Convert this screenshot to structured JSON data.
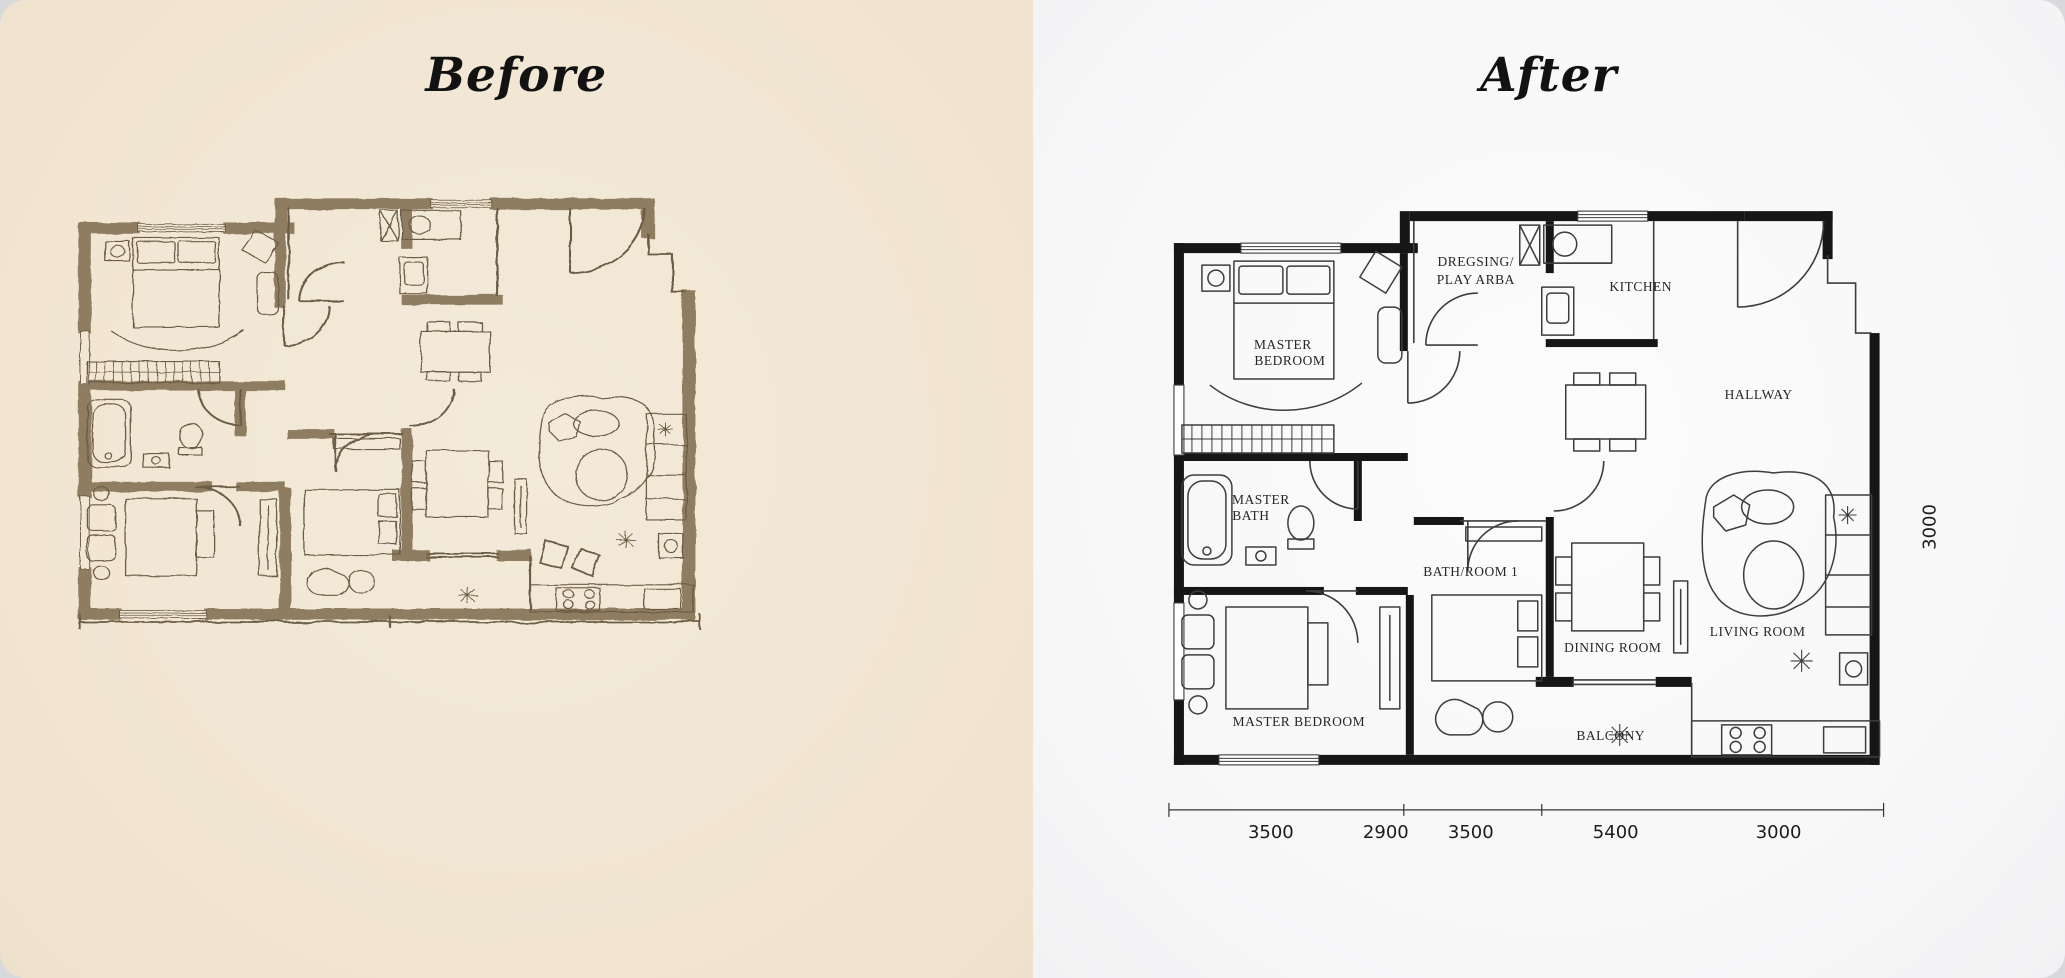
{
  "page": {
    "background_color": "#d8d9db",
    "card_radius_px": 26
  },
  "before_panel": {
    "title": "Before",
    "background_color": "#f2e7d5",
    "description": "hand-drawn sepia sketch floor plan",
    "ink_color": "#6b5b44",
    "wall_color": "#8e7d61"
  },
  "after_panel": {
    "title": "After",
    "background_color": "#f7f7f8",
    "description": "clean CAD floor plan",
    "wall_color": "#161616",
    "rooms": {
      "master_bedroom_top": [
        "MASTER",
        "BEDROOM"
      ],
      "dressing": [
        "DREGSING/",
        "PLAY ARBA"
      ],
      "kitchen": "KITCHEN",
      "hallway": "HALLWAY",
      "master_bath": [
        "MASTER",
        "BATH"
      ],
      "bathroom_1": "BATH/ROOM 1",
      "dining_room": "DINING ROOM",
      "living_room": "LIVING ROOM",
      "master_bedroom_bottom": "MASTER BEDROOM",
      "balcony": "BALCONY"
    },
    "dimensions": {
      "bottom": [
        "3500",
        "2900",
        "3500",
        "5400",
        "3000"
      ],
      "right": "3000"
    }
  }
}
